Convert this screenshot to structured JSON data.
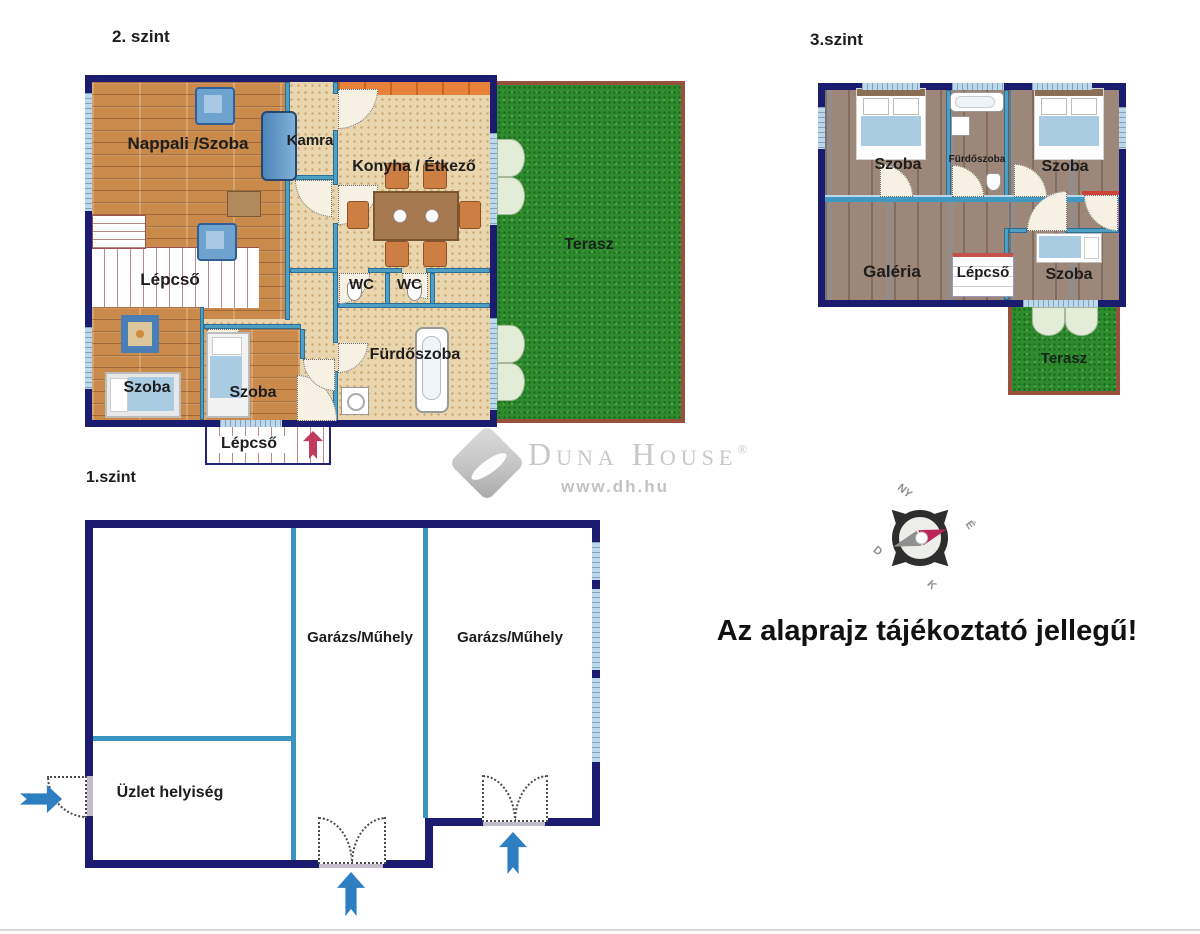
{
  "floor2": {
    "title": "2. szint",
    "nappali": "Nappali /Szoba",
    "kamra": "Kamra",
    "konyha": "Konyha / Étkező",
    "terasz": "Terasz",
    "lepcso_top": "Lépcső",
    "wc1": "WC",
    "wc2": "WC",
    "furdoszoba": "Fürdőszoba",
    "szoba_left": "Szoba",
    "szoba_mid": "Szoba",
    "lepcso_exit": "Lépcső"
  },
  "floor3": {
    "title": "3.szint",
    "szoba_left": "Szoba",
    "furdoszoba": "Fürdőszoba",
    "szoba_right": "Szoba",
    "galeria": "Galéria",
    "lepcso": "Lépcső",
    "szoba_small": "Szoba",
    "terasz": "Terasz"
  },
  "floor1": {
    "title": "1.szint",
    "garazs_1": "Garázs/Műhely",
    "garazs_2": "Garázs/Műhely",
    "uzlet": "Üzlet helyiség"
  },
  "logo": {
    "brand": "Duna House",
    "reg": "®",
    "url": "www.dh.hu"
  },
  "compass": {
    "north": "É",
    "south": "D",
    "east": "K",
    "west": "NY"
  },
  "disclaimer": "Az alaprajz tájékoztató jellegű!",
  "colors": {
    "wall": "#1b1b70",
    "inner_wall": "#4d9fc4",
    "window": "#bcd8ea",
    "grass": "#2e8b2e",
    "terrace_border": "#96503c",
    "wood": "#c98a4c",
    "floor_beige": "#e9d5ae",
    "floor_taupe": "#9d8779",
    "counter_orange": "#e8823a",
    "arrow_red": "#c23b5e",
    "arrow_blue": "#2d7fc1",
    "logo_gray": "#c8c8c8"
  }
}
